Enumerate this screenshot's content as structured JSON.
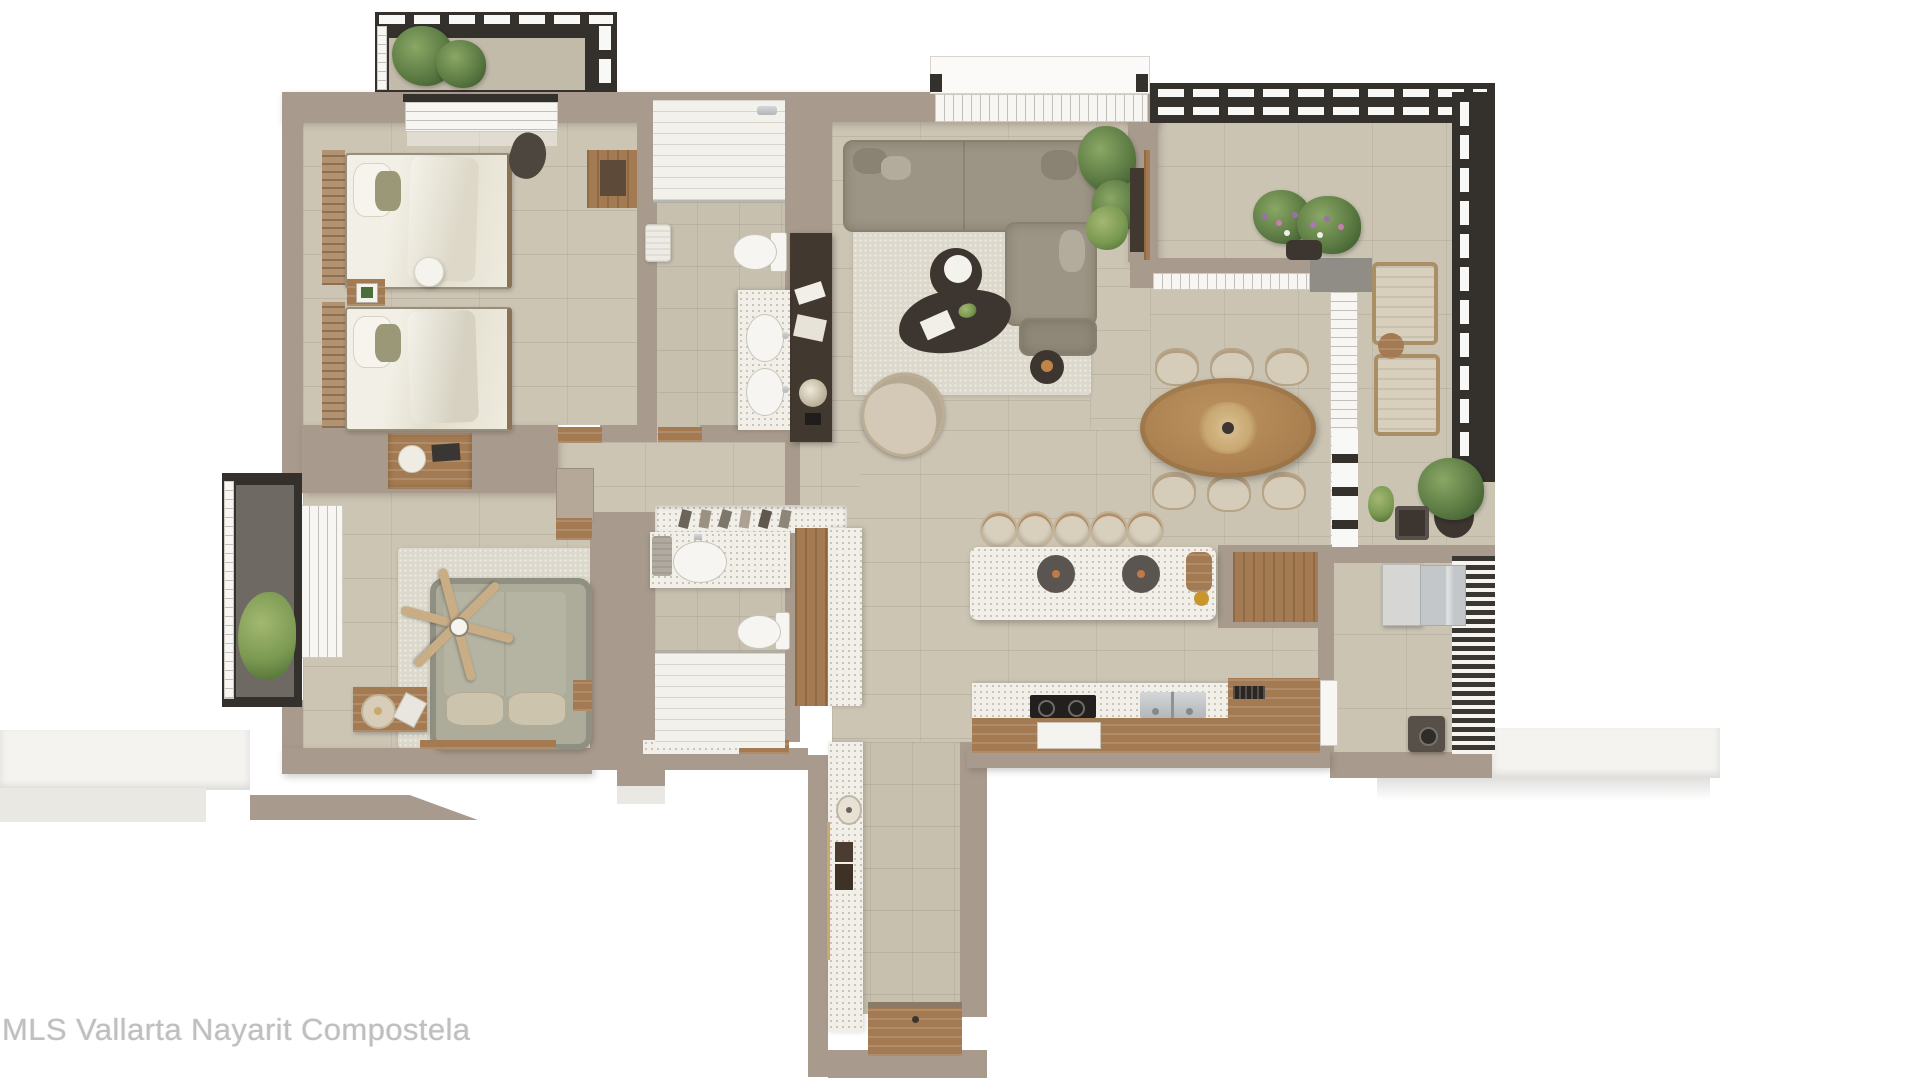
{
  "watermark": {
    "text": "MLS Vallarta Nayarit Compostela"
  },
  "palette": {
    "wall": "#a89b8d",
    "wall_dark": "#8f8275",
    "floor": "#cdc5b4",
    "bath_floor": "#c7c0af",
    "terrace_floor": "#cbc4b3",
    "terrazzo": "#f1efe8",
    "rug": "#dcd8cb",
    "wood": "#a37a51",
    "wood_dark": "#7c5f42",
    "dark": "#3d3630",
    "sofa": "#9c9484",
    "sage": "#adac9b",
    "green": "#5d7c44",
    "steel": "#c3c6c7",
    "frame": "#34312d",
    "copper": "#c07a45",
    "gold": "#c9a96d",
    "watermark": "#bfbfbf"
  },
  "scene": {
    "type": "apartment-floor-plan-3d-render",
    "view": "top-down",
    "rooms": [
      "bedroom-1-twin",
      "bathroom-1",
      "hallway",
      "living-room",
      "dining-area",
      "kitchen",
      "bedroom-2-master",
      "bathroom-2",
      "closet",
      "entry-corridor",
      "laundry-room",
      "terrace",
      "balcony-bedroom-1",
      "balcony-bedroom-2"
    ],
    "furniture": [
      "twin-bed-1",
      "twin-bed-2",
      "night-stand",
      "wardrobe",
      "desk",
      "sofa-sectional",
      "coffee-table-round",
      "coffee-table-organic",
      "accent-chair",
      "tv-console",
      "floor-plant",
      "dining-table-oval",
      "dining-chairs-6",
      "kitchen-island",
      "bar-stools-5",
      "cooktop",
      "oven",
      "double-sink",
      "master-bed",
      "ceiling-fan",
      "lounge-chairs-2",
      "planter-flowers",
      "washer-dryer",
      "toilet-2",
      "vanity-sinks",
      "showers-2",
      "entry-door"
    ]
  }
}
